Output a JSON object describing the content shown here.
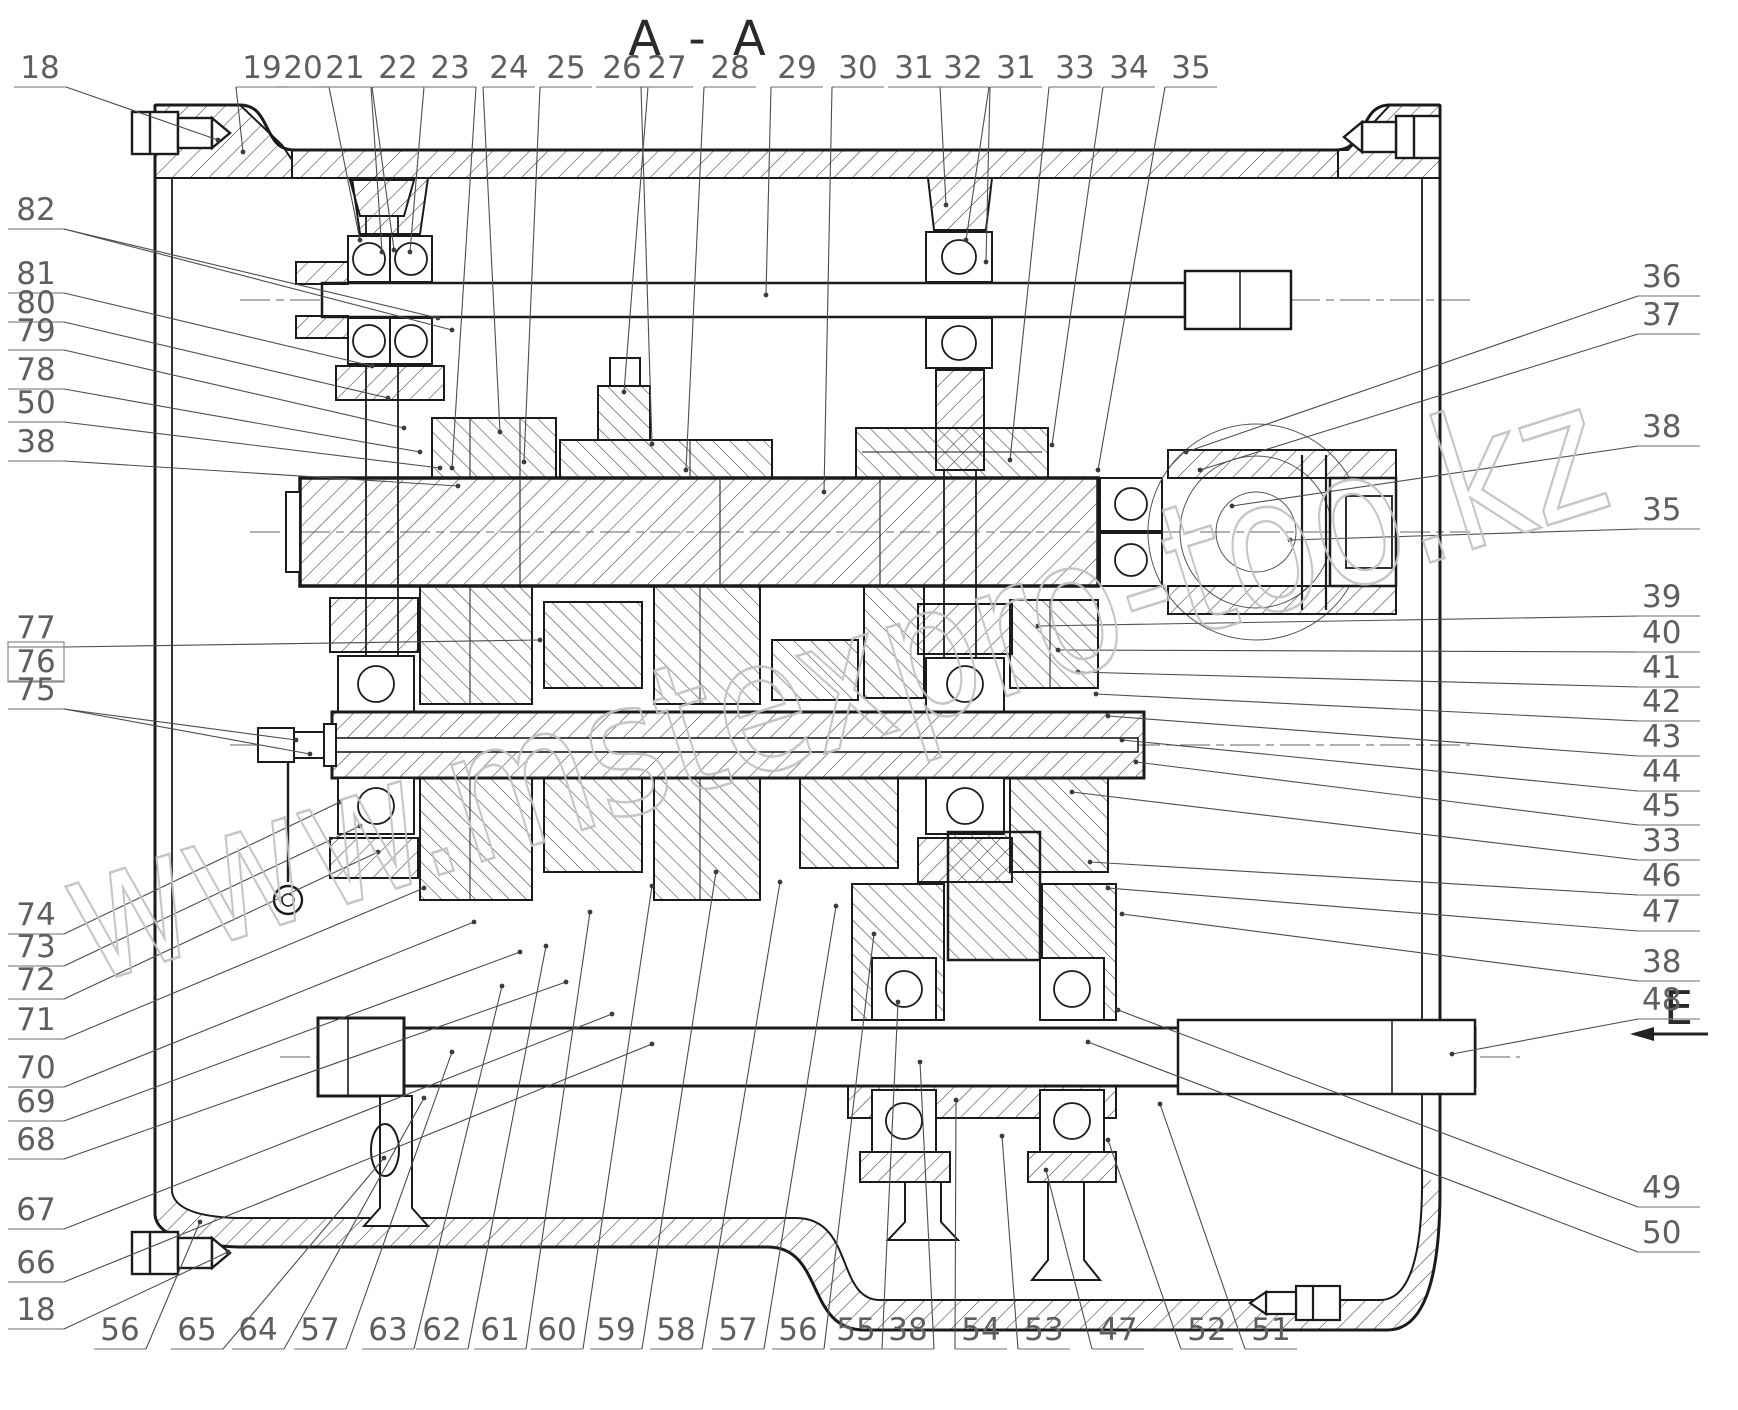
{
  "title": "A - A",
  "view_label": {
    "letter": "E"
  },
  "watermark": "www.mstexpro-too.kz",
  "callouts": {
    "top": [
      "18",
      "19",
      "20",
      "21",
      "22",
      "23",
      "24",
      "25",
      "26",
      "27",
      "28",
      "29",
      "30",
      "31",
      "32",
      "31",
      "33",
      "34",
      "35"
    ],
    "left_upper": [
      "82",
      "81",
      "80",
      "79",
      "78",
      "50",
      "38"
    ],
    "left_middle": [
      "77",
      "76",
      "75"
    ],
    "left_lower": [
      "74",
      "73",
      "72",
      "71",
      "70",
      "69",
      "68",
      "67",
      "66",
      "18"
    ],
    "bottom": [
      "56",
      "65",
      "64",
      "57",
      "63",
      "62",
      "61",
      "60",
      "59",
      "58",
      "57",
      "56",
      "55",
      "38",
      "54",
      "53",
      "47",
      "52",
      "51"
    ],
    "right": [
      "36",
      "37",
      "38",
      "35",
      "39",
      "40",
      "41",
      "42",
      "43",
      "44",
      "45",
      "33",
      "46",
      "47",
      "38",
      "48",
      "49",
      "50"
    ]
  },
  "boxed_labels": [
    "76"
  ],
  "drawing": {
    "kind": "gearbox sectional view",
    "shafts": [
      "upper-input-shaft",
      "main-shaft",
      "counter-shaft",
      "output-shaft"
    ]
  },
  "colors": {
    "line": "#1b1b1b",
    "label": "#5f5f5f",
    "accent": "#2a2a2a",
    "watermark": "#c2c2c2",
    "background": "#ffffff"
  }
}
